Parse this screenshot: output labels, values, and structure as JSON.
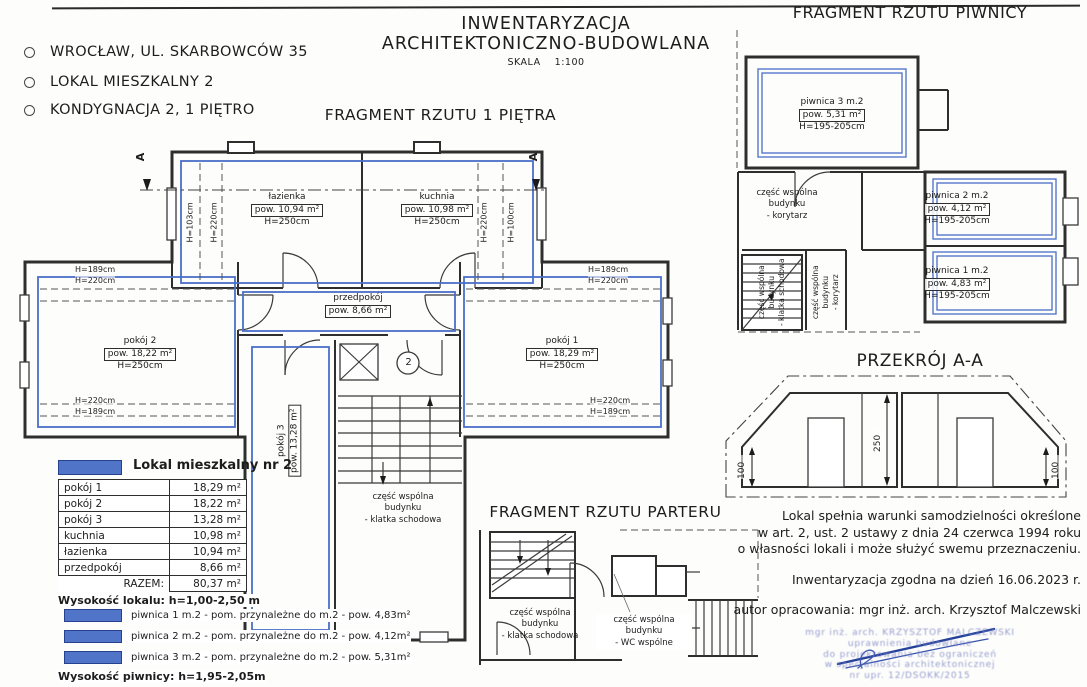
{
  "colors": {
    "highlight_blue": "#4a6fc8",
    "wall": "#2e2e2e",
    "stamp_blue": "#7d86c5"
  },
  "header": {
    "address": "WROCŁAW,  UL. SKARBOWCÓW 35",
    "unit": "LOKAL MIESZKALNY 2",
    "storey": "KONDYGNACJA 2, 1 PIĘTRO"
  },
  "title": {
    "line1": "INWENTARYZACJA",
    "line2": "ARCHITEKTONICZNO-BUDOWLANA",
    "scale": "SKALA    1:100"
  },
  "main_plan": {
    "title": "FRAGMENT RZUTU 1 PIĘTRA",
    "section_marker": "A",
    "unit_number": "2",
    "rooms": {
      "lazienka": {
        "name": "łazienka",
        "area": "pow. 10,94 m²",
        "height": "H=250cm"
      },
      "kuchnia": {
        "name": "kuchnia",
        "area": "pow. 10,98 m²",
        "height": "H=250cm"
      },
      "przedpokoj": {
        "name": "przedpokój",
        "area": "pow. 8,66  m²"
      },
      "pokoj1": {
        "name": "pokój 1",
        "area": "pow. 18,29 m²",
        "height": "H=250cm"
      },
      "pokoj2": {
        "name": "pokój 2",
        "area": "pow. 18,22 m²",
        "height": "H=250cm"
      },
      "pokoj3": {
        "name": "pokój 3",
        "area": "pow. 13,28 m²"
      }
    },
    "common_area": [
      "część wspólna",
      "budynku",
      "- klatka schodowa"
    ],
    "heights": {
      "h103": "H=103cm",
      "h220": "H=220cm",
      "h100": "H=100cm",
      "h189": "H=189cm"
    }
  },
  "basement_plan": {
    "title": "FRAGMENT RZUTU PIWNICY",
    "rooms": {
      "p3": {
        "name": "piwnica 3 m.2",
        "area": "pow. 5,31  m²",
        "height": "H=195-205cm"
      },
      "p2": {
        "name": "piwnica 2 m.2",
        "area": "pow. 4,12  m²",
        "height": "H=195-205cm"
      },
      "p1": {
        "name": "piwnica 1 m.2",
        "area": "pow. 4,83  m²",
        "height": "H=195-205cm"
      }
    },
    "corridor_label": [
      "część wspólna",
      "budynku",
      "- korytarz"
    ],
    "stair_label": [
      "część wspólna",
      "budynku",
      "- klatka schodowa"
    ],
    "corridor_label2": [
      "część wspólna",
      "budynku",
      "- korytarz"
    ]
  },
  "section": {
    "title": "PRZEKRÓJ A-A",
    "dim_250": "250",
    "dim_100": "100"
  },
  "ground_plan": {
    "title": "FRAGMENT RZUTU PARTERU",
    "stair_label": [
      "część wspólna",
      "budynku",
      "- klatka schodowa"
    ],
    "wc_label": [
      "część wspólna",
      "budynku",
      "- WC wspólne"
    ]
  },
  "legend": {
    "title": "Lokal mieszkalny nr 2",
    "rows": [
      {
        "label": "pokój 1",
        "value": "18,29 m²"
      },
      {
        "label": "pokój 2",
        "value": "18,22 m²"
      },
      {
        "label": "pokój 3",
        "value": "13,28 m²"
      },
      {
        "label": "kuchnia",
        "value": "10,98 m²"
      },
      {
        "label": "łazienka",
        "value": "10,94 m²"
      },
      {
        "label": "przedpokój",
        "value": "8,66 m²"
      }
    ],
    "total_label": "RAZEM:",
    "total_value": "80,37 m²",
    "height_note": "Wysokość lokalu: h=1,00-2,50 m",
    "basement_items": [
      "piwnica 1 m.2 - pom. przynależne do m.2 - pow. 4,83m²",
      "piwnica 2 m.2 - pom. przynależne do m.2 - pow. 4,12m²",
      "piwnica 3 m.2 - pom. przynależne do m.2 - pow. 5,31m²"
    ],
    "basement_height_note": "Wysokość piwnicy: h=1,95-2,05m"
  },
  "notes": {
    "statement": [
      "Lokal spełnia warunki samodzielności określone",
      "w art. 2, ust. 2 ustawy z dnia 24 czerwca 1994 roku",
      "o własności lokali i może służyć swemu przeznaczeniu."
    ],
    "date_note": "Inwentaryzacja zgodna na dzień 16.06.2023 r.",
    "author": "autor opracowania: mgr inż. arch. Krzysztof Malczewski",
    "stamp_lines": [
      "mgr inż. arch. KRZYSZTOF MALCZEWSKI",
      "uprawnienia budowlane",
      "do projektowania bez ograniczeń",
      "w specjalności architektonicznej",
      "nr upr. 12/DSOKK/2015"
    ]
  }
}
